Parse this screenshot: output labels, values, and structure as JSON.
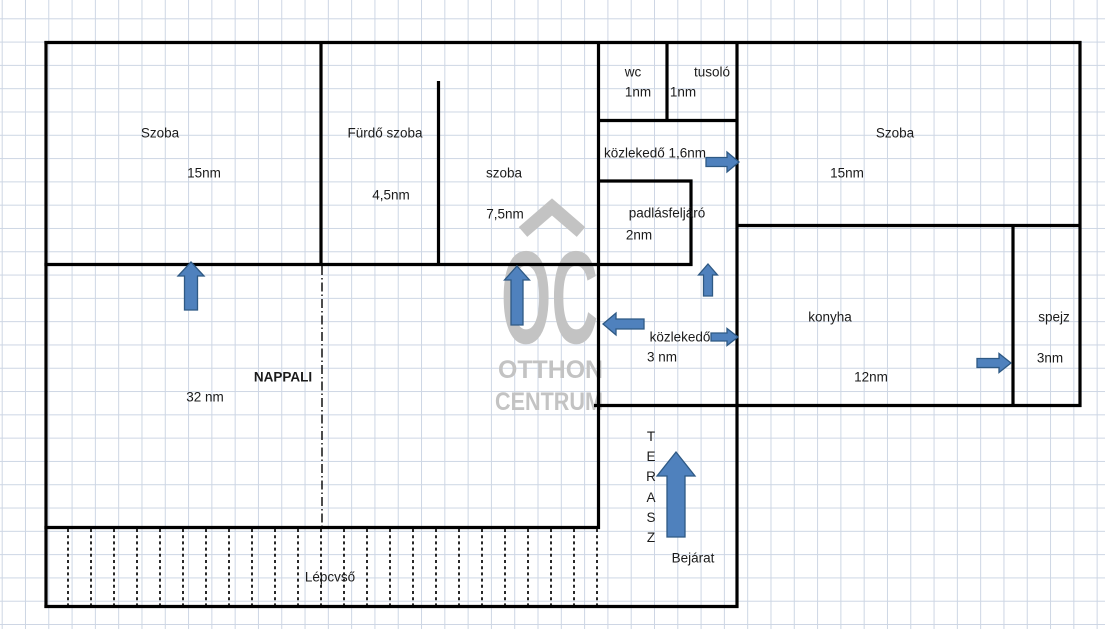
{
  "plan_title": "floor-plan",
  "colors": {
    "wall": "#000000",
    "grid": "#cdd6e4",
    "text": "#1b1b1b",
    "arrow_fill": "#4f81bd",
    "arrow_stroke": "#2e5984",
    "watermark": "#c3c3c3"
  },
  "watermark": {
    "brand_acronym": "OC",
    "line1": "OTTHON",
    "line2": "CENTRUM"
  },
  "labels": [
    {
      "id": "szoba-left",
      "name": "Szoba",
      "area": "15nm",
      "name_pos": [
        160,
        133
      ],
      "area_pos": [
        204,
        173
      ]
    },
    {
      "id": "furdo-szoba",
      "name": "Fürdő szoba",
      "area": "4,5nm",
      "name_pos": [
        385,
        133
      ],
      "area_pos": [
        391,
        195
      ]
    },
    {
      "id": "szoba-middle",
      "name": "szoba",
      "area": "7,5nm",
      "name_pos": [
        504,
        173
      ],
      "area_pos": [
        505,
        214
      ]
    },
    {
      "id": "wc",
      "name": "wc",
      "area": "1nm",
      "name_pos": [
        633,
        72
      ],
      "area_pos": [
        638,
        92
      ]
    },
    {
      "id": "tusolo",
      "name": "tusoló",
      "area": "1nm",
      "name_pos": [
        712,
        72
      ],
      "area_pos": [
        683,
        92
      ]
    },
    {
      "id": "kozlekedo-upper",
      "name": "közlekedő",
      "area": "1,6nm",
      "name_pos": [
        655,
        153
      ],
      "combined": true
    },
    {
      "id": "padlasfeljaro",
      "name": "padlásfeljáró",
      "area": "2nm",
      "name_pos": [
        667,
        213
      ],
      "area_pos": [
        639,
        235
      ]
    },
    {
      "id": "szoba-right",
      "name": "Szoba",
      "area": "15nm",
      "name_pos": [
        895,
        133
      ],
      "area_pos": [
        847,
        173
      ]
    },
    {
      "id": "nappali",
      "name": "NAPPALI",
      "area": "32 nm",
      "name_pos": [
        283,
        377
      ],
      "area_pos": [
        205,
        397
      ],
      "bold": true
    },
    {
      "id": "kozlekedo-lower",
      "name": "közlekedő",
      "area": "3 nm",
      "name_pos": [
        680,
        337
      ],
      "area_pos": [
        662,
        357
      ]
    },
    {
      "id": "konyha",
      "name": "konyha",
      "area": "12nm",
      "name_pos": [
        830,
        317
      ],
      "area_pos": [
        871,
        377
      ]
    },
    {
      "id": "spejz",
      "name": "spejz",
      "area": "3nm",
      "name_pos": [
        1054,
        317
      ],
      "area_pos": [
        1050,
        358
      ]
    },
    {
      "id": "bejarat",
      "name": "Bejárat",
      "name_pos": [
        693,
        558
      ]
    },
    {
      "id": "lepcso",
      "name": "Lépcvső",
      "name_pos": [
        330,
        577
      ]
    }
  ],
  "terasz": {
    "letters": [
      "T",
      "E",
      "R",
      "A",
      "S",
      "Z"
    ],
    "x": 651,
    "y_top": 427
  },
  "walls": [
    [
      44.4,
      42.5,
      1081.5,
      42.5
    ],
    [
      597,
      120.5,
      738.5,
      120.5
    ],
    [
      597,
      181,
      692.5,
      181
    ],
    [
      735.5,
      225.5,
      1081.5,
      225.5
    ],
    [
      44.4,
      264.5,
      692.5,
      264.5
    ],
    [
      594,
      405.5,
      1081.5,
      405.5
    ],
    [
      44.4,
      527.5,
      600,
      527.5
    ],
    [
      44.4,
      606.5,
      738.5,
      606.5
    ],
    [
      46,
      41,
      46,
      608
    ],
    [
      321,
      41,
      321,
      266
    ],
    [
      438.5,
      81,
      438.5,
      266
    ],
    [
      598.5,
      41,
      598.5,
      529
    ],
    [
      667,
      41,
      667,
      122
    ],
    [
      691,
      179.5,
      691,
      266
    ],
    [
      737,
      41,
      737,
      608
    ],
    [
      1013,
      224,
      1013,
      407
    ],
    [
      1080,
      41,
      1080,
      407
    ]
  ],
  "nappali_divider": [
    322,
    266,
    322,
    526
  ],
  "stairs": {
    "x_start": 68,
    "x_step": 23,
    "count": 24,
    "y1": 529,
    "y2": 605
  },
  "arrows": [
    {
      "id": "door-nappali-szoba-left",
      "dir": "up",
      "tip": [
        191,
        262
      ],
      "len": 48,
      "shaft_w": 13,
      "head_w": 26,
      "head_l": 14
    },
    {
      "id": "door-nappali-szoba-middle",
      "dir": "up",
      "tip": [
        517,
        266
      ],
      "len": 59,
      "shaft_w": 12,
      "head_w": 25,
      "head_l": 14
    },
    {
      "id": "door-kozlekedo-szoba-right",
      "dir": "right",
      "tip": [
        739,
        162
      ],
      "len": 33,
      "shaft_w": 9,
      "head_w": 20,
      "head_l": 12
    },
    {
      "id": "door-kozlekedo-padlasfeljaro",
      "dir": "up",
      "tip": [
        708,
        264
      ],
      "len": 32,
      "shaft_w": 9,
      "head_w": 19,
      "head_l": 11
    },
    {
      "id": "door-kozlekedo-nappali",
      "dir": "left",
      "tip": [
        603,
        324
      ],
      "len": 41,
      "shaft_w": 10,
      "head_w": 22,
      "head_l": 13
    },
    {
      "id": "door-kozlekedo-konyha",
      "dir": "right",
      "tip": [
        738,
        337
      ],
      "len": 27,
      "shaft_w": 8,
      "head_w": 17,
      "head_l": 11
    },
    {
      "id": "door-konyha-spejz",
      "dir": "right",
      "tip": [
        1011,
        363
      ],
      "len": 34,
      "shaft_w": 9,
      "head_w": 19,
      "head_l": 12
    },
    {
      "id": "entrance-terasz",
      "dir": "up",
      "tip": [
        676,
        452
      ],
      "len": 85,
      "shaft_w": 18,
      "head_w": 38,
      "head_l": 24
    }
  ]
}
